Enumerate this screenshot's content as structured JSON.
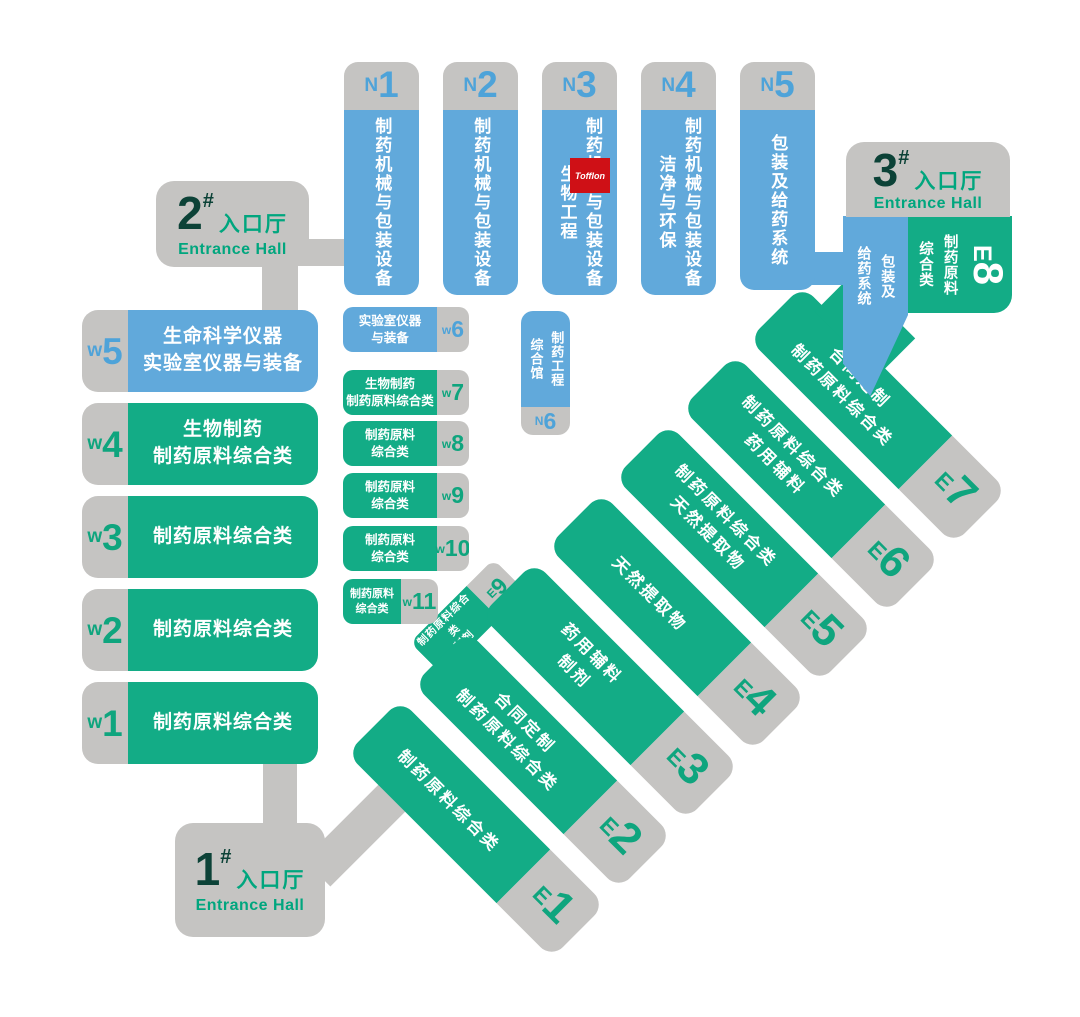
{
  "colors": {
    "blue": "#61a9db",
    "green": "#13ac86",
    "gray": "#c5c4c2",
    "dark_number": "#0c4237",
    "entrance_text": "#00a67e",
    "tofflon_red": "#cf1016"
  },
  "entrances": {
    "no1": {
      "number": "1",
      "hash": "#",
      "label_cn": "入口厅",
      "label_en": "Entrance Hall"
    },
    "no2": {
      "number": "2",
      "hash": "#",
      "label_cn": "入口厅",
      "label_en": "Entrance Hall"
    },
    "no3": {
      "number": "3",
      "hash": "#",
      "label_cn": "入口厅",
      "label_en": "Entrance Hall"
    }
  },
  "north_halls": [
    {
      "id": "N1",
      "letter": "N",
      "num": "1",
      "lines": [
        "制药机械与包装设备"
      ]
    },
    {
      "id": "N2",
      "letter": "N",
      "num": "2",
      "lines": [
        "制药机械与包装设备"
      ]
    },
    {
      "id": "N3",
      "letter": "N",
      "num": "3",
      "lines": [
        "制药机械与包装设备",
        "生物工程"
      ]
    },
    {
      "id": "N4",
      "letter": "N",
      "num": "4",
      "lines": [
        "制药机械与包装设备",
        "洁净与环保"
      ]
    },
    {
      "id": "N5",
      "letter": "N",
      "num": "5",
      "lines": [
        "包装及给药系统"
      ]
    }
  ],
  "n6": {
    "id": "N6",
    "letter": "N",
    "num": "6",
    "lines": [
      "制药工程",
      "综合馆"
    ]
  },
  "west_large": [
    {
      "id": "W5",
      "letter": "w",
      "num": "5",
      "lines": [
        "生命科学仪器",
        "实验室仪器与装备"
      ]
    },
    {
      "id": "W4",
      "letter": "w",
      "num": "4",
      "lines": [
        "生物制药",
        "制药原料综合类"
      ]
    },
    {
      "id": "W3",
      "letter": "w",
      "num": "3",
      "lines": [
        "制药原料综合类"
      ]
    },
    {
      "id": "W2",
      "letter": "w",
      "num": "2",
      "lines": [
        "制药原料综合类"
      ]
    },
    {
      "id": "W1",
      "letter": "w",
      "num": "1",
      "lines": [
        "制药原料综合类"
      ]
    }
  ],
  "west_small": [
    {
      "id": "W6",
      "letter": "w",
      "num": "6",
      "lines": [
        "实验室仪器",
        "与装备"
      ]
    },
    {
      "id": "W7",
      "letter": "w",
      "num": "7",
      "lines": [
        "生物制药",
        "制药原料综合类"
      ]
    },
    {
      "id": "W8",
      "letter": "w",
      "num": "8",
      "lines": [
        "制药原料",
        "综合类"
      ]
    },
    {
      "id": "W9",
      "letter": "w",
      "num": "9",
      "lines": [
        "制药原料",
        "综合类"
      ]
    },
    {
      "id": "W10",
      "letter": "w",
      "num": "10",
      "lines": [
        "制药原料",
        "综合类"
      ]
    },
    {
      "id": "W11",
      "letter": "w",
      "num": "11",
      "lines": [
        "制药原料",
        "综合类"
      ]
    }
  ],
  "east_halls": [
    {
      "id": "E1",
      "letter": "E",
      "num": "1",
      "lines": [
        "制药原料综合类"
      ]
    },
    {
      "id": "E2",
      "letter": "E",
      "num": "2",
      "lines": [
        "合同定制",
        "制药原料综合类"
      ]
    },
    {
      "id": "E3",
      "letter": "E",
      "num": "3",
      "lines": [
        "药用辅料",
        "制剂"
      ]
    },
    {
      "id": "E4",
      "letter": "E",
      "num": "4",
      "lines": [
        "天然提取物"
      ]
    },
    {
      "id": "E5",
      "letter": "E",
      "num": "5",
      "lines": [
        "制药原料综合类",
        "天然提取物"
      ]
    },
    {
      "id": "E6",
      "letter": "E",
      "num": "6",
      "lines": [
        "制药原料综合类",
        "药用辅料"
      ]
    },
    {
      "id": "E7",
      "letter": "E",
      "num": "7",
      "lines": [
        "合同定制",
        "制药原料综合类"
      ]
    }
  ],
  "e9": {
    "id": "E9",
    "letter": "E",
    "num": "9",
    "lines": [
      "制药原料综合类",
      "制剂"
    ]
  },
  "e8": {
    "id": "E8",
    "letter": "E",
    "num": "8",
    "lines": [
      "制药原料",
      "综合类"
    ]
  },
  "packaging_strip": {
    "lines": [
      "包装及",
      "给药系统"
    ]
  },
  "tofflon": {
    "label": "Tofflon"
  }
}
